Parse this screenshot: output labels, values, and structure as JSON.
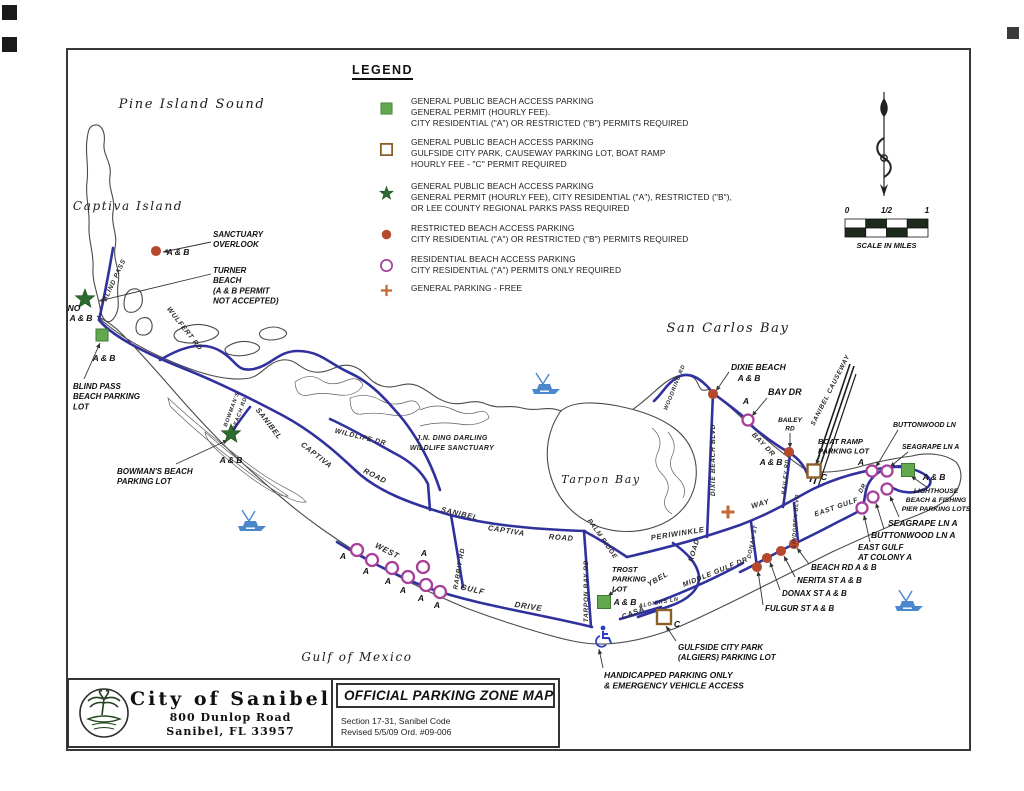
{
  "title_block": {
    "city_name": "City of Sanibel",
    "address_line1": "800 Dunlop Road",
    "address_line2": "Sanibel, FL  33957",
    "map_title": "OFFICIAL PARKING ZONE MAP",
    "section_line1": "Section 17-31, Sanibel Code",
    "section_line2": "Revised 5/5/09 Ord. #09-006"
  },
  "legend": {
    "title": "LEGEND",
    "items": [
      {
        "marker": "green-square",
        "top": 96,
        "lines": [
          "GENERAL PUBLIC BEACH ACCESS PARKING",
          "GENERAL PERMIT (HOURLY FEE).",
          "CITY RESIDENTIAL (\"A\") OR RESTRICTED (\"B\") PERMITS REQUIRED"
        ]
      },
      {
        "marker": "open-square",
        "top": 137,
        "lines": [
          "GENERAL PUBLIC BEACH ACCESS PARKING",
          "GULFSIDE CITY PARK, CAUSEWAY PARKING LOT, BOAT RAMP",
          "HOURLY FEE - \"C\" PERMIT REQUIRED"
        ]
      },
      {
        "marker": "green-star",
        "top": 181,
        "lines": [
          "GENERAL PUBLIC BEACH ACCESS PARKING",
          "GENERAL PERMIT (HOURLY FEE), CITY RESIDENTIAL (\"A\"), RESTRICTED (\"B\"),",
          "OR LEE COUNTY REGIONAL PARKS PASS REQUIRED"
        ]
      },
      {
        "marker": "red-dot",
        "top": 223,
        "lines": [
          "RESTRICTED BEACH ACCESS PARKING",
          "CITY RESIDENTIAL (\"A\") OR RESTRICTED (\"B\") PERMITS REQUIRED"
        ]
      },
      {
        "marker": "open-circle",
        "top": 254,
        "lines": [
          "RESIDENTIAL BEACH ACCESS PARKING",
          "CITY RESIDENTIAL (\"A\") PERMITS ONLY REQUIRED"
        ]
      },
      {
        "marker": "plus",
        "top": 283,
        "lines": [
          "GENERAL PARKING - FREE"
        ]
      }
    ]
  },
  "scale_bar": {
    "ticks": [
      "0",
      "1/2",
      "1"
    ],
    "caption": "SCALE IN MILES"
  },
  "water_labels": [
    {
      "text": "Pine Island Sound",
      "x": 192,
      "y": 108,
      "size": 13
    },
    {
      "text": "Captiva Island",
      "x": 128,
      "y": 210,
      "size": 12
    },
    {
      "text": "San Carlos Bay",
      "x": 728,
      "y": 332,
      "size": 13
    },
    {
      "text": "Tarpon Bay",
      "x": 601,
      "y": 483,
      "size": 11
    },
    {
      "text": "Gulf of Mexico",
      "x": 357,
      "y": 661,
      "size": 12
    }
  ],
  "area_labels": [
    {
      "text": "J.N. DING DARLING",
      "x": 452,
      "y": 440
    },
    {
      "text": "WILDLIFE SANCTUARY",
      "x": 452,
      "y": 450
    }
  ],
  "road_labels": [
    {
      "text": "BLIND PASS",
      "x": 116,
      "y": 281,
      "rot": -65,
      "size": 6.5
    },
    {
      "text": "WULFERT RD",
      "x": 183,
      "y": 330,
      "rot": 52,
      "size": 7
    },
    {
      "text": "SANIBEL",
      "x": 267,
      "y": 425,
      "rot": 52,
      "size": 7.5
    },
    {
      "text": "CAPTIVA",
      "x": 315,
      "y": 457,
      "rot": 38,
      "size": 7.5
    },
    {
      "text": "ROAD",
      "x": 374,
      "y": 478,
      "rot": 27,
      "size": 7.5
    },
    {
      "text": "BOWMAN'S",
      "x": 233,
      "y": 410,
      "rot": -70,
      "size": 5.5
    },
    {
      "text": "BEACH RD",
      "x": 241,
      "y": 414,
      "rot": -70,
      "size": 5.5
    },
    {
      "text": "WILDLIFE DR",
      "x": 360,
      "y": 439,
      "rot": 14,
      "size": 7
    },
    {
      "text": "SANIBEL",
      "x": 459,
      "y": 516,
      "rot": 13,
      "size": 7.5
    },
    {
      "text": "CAPTIVA",
      "x": 506,
      "y": 533,
      "rot": 9,
      "size": 7.5
    },
    {
      "text": "ROAD",
      "x": 561,
      "y": 540,
      "rot": 4,
      "size": 7.5
    },
    {
      "text": "RABBIT RD",
      "x": 461,
      "y": 569,
      "rot": -80,
      "size": 6.5
    },
    {
      "text": "WEST",
      "x": 386,
      "y": 553,
      "rot": 27,
      "size": 8
    },
    {
      "text": "GULF",
      "x": 472,
      "y": 592,
      "rot": 13,
      "size": 8
    },
    {
      "text": "DRIVE",
      "x": 528,
      "y": 609,
      "rot": 9,
      "size": 8
    },
    {
      "text": "TARPON BAY RD",
      "x": 588,
      "y": 591,
      "rot": -90,
      "size": 6.5
    },
    {
      "text": "PALM RIDGE",
      "x": 601,
      "y": 540,
      "rot": 55,
      "size": 6.5
    },
    {
      "text": "PERIWINKLE",
      "x": 678,
      "y": 536,
      "rot": -9,
      "size": 7.5
    },
    {
      "text": "WAY",
      "x": 761,
      "y": 506,
      "rot": -16,
      "size": 7.5
    },
    {
      "text": "DIXIE BEACH BLVD",
      "x": 715,
      "y": 460,
      "rot": -90,
      "size": 6.5
    },
    {
      "text": "WOODRING RD",
      "x": 676,
      "y": 388,
      "rot": -68,
      "size": 5.5
    },
    {
      "text": "BAY DR",
      "x": 762,
      "y": 446,
      "rot": 46,
      "size": 7
    },
    {
      "text": "BAILEY RD",
      "x": 787,
      "y": 477,
      "rot": -84,
      "size": 5.5
    },
    {
      "text": "SANIBEL CAUSEWAY",
      "x": 832,
      "y": 391,
      "rot": -63,
      "size": 6.5
    },
    {
      "text": "LINDGREN BLVD",
      "x": 797,
      "y": 521,
      "rot": -86,
      "size": 5.5
    },
    {
      "text": "EAST GULF",
      "x": 837,
      "y": 509,
      "rot": -19,
      "size": 7
    },
    {
      "text": "DR",
      "x": 864,
      "y": 489,
      "rot": -60,
      "size": 6
    },
    {
      "text": "MIDDLE GULF DR",
      "x": 716,
      "y": 574,
      "rot": -22,
      "size": 7
    },
    {
      "text": "CASA",
      "x": 634,
      "y": 615,
      "rot": -22,
      "size": 7.5
    },
    {
      "text": "YBEL",
      "x": 659,
      "y": 581,
      "rot": -30,
      "size": 7.5
    },
    {
      "text": "ROAD",
      "x": 696,
      "y": 551,
      "rot": -73,
      "size": 7
    },
    {
      "text": "ALGIERS LN",
      "x": 659,
      "y": 604,
      "rot": -10,
      "size": 5.5
    },
    {
      "text": "DONAX ST",
      "x": 754,
      "y": 542,
      "rot": -78,
      "size": 5.5
    }
  ],
  "callouts": [
    {
      "lines": [
        "SANCTUARY",
        "OVERLOOK"
      ],
      "x": 213,
      "y": 237,
      "size": 8,
      "leader": [
        211,
        242,
        163,
        252
      ]
    },
    {
      "lines": [
        "TURNER",
        "BEACH",
        "(A & B PERMIT",
        "NOT ACCEPTED)"
      ],
      "x": 213,
      "y": 273,
      "size": 8,
      "leader": [
        211,
        274,
        99,
        301
      ]
    },
    {
      "lines": [
        "BLIND PASS",
        "BEACH PARKING",
        "LOT"
      ],
      "x": 73,
      "y": 389,
      "size": 8,
      "leader": [
        84,
        379,
        100,
        343
      ]
    },
    {
      "lines": [
        "BOWMAN'S BEACH",
        "PARKING LOT"
      ],
      "x": 117,
      "y": 474,
      "size": 8,
      "leader": [
        176,
        464,
        228,
        440
      ]
    },
    {
      "lines": [
        "TROST",
        "PARKING",
        "LOT"
      ],
      "x": 612,
      "y": 572,
      "size": 7.5,
      "leader": [
        617,
        589,
        608,
        596
      ]
    },
    {
      "lines": [
        "GULFSIDE CITY PARK",
        "(ALGIERS) PARKING LOT"
      ],
      "x": 678,
      "y": 650,
      "size": 8,
      "leader": [
        676,
        641,
        666,
        626
      ]
    },
    {
      "lines": [
        "HANDICAPPED PARKING ONLY",
        "& EMERGENCY VEHICLE ACCESS"
      ],
      "x": 604,
      "y": 678,
      "size": 8.5,
      "leader": [
        603,
        668,
        599,
        649
      ]
    },
    {
      "lines": [
        "DIXIE BEACH"
      ],
      "x": 731,
      "y": 370,
      "size": 8.5,
      "leader": [
        729,
        372,
        716,
        391
      ]
    },
    {
      "lines": [
        "BAY DR"
      ],
      "x": 768,
      "y": 395,
      "size": 9,
      "leader": [
        767,
        398,
        752,
        416
      ]
    },
    {
      "lines": [
        "BAILEY",
        "RD"
      ],
      "x": 790,
      "y": 422,
      "size": 6.5,
      "align": "center",
      "leader": [
        790,
        433,
        790,
        448
      ]
    },
    {
      "lines": [
        "BOAT RAMP",
        "PARKING LOT"
      ],
      "x": 818,
      "y": 444,
      "size": 7.5,
      "leader": [
        820,
        455,
        816,
        465
      ]
    },
    {
      "lines": [
        "BUTTONWOOD LN"
      ],
      "x": 893,
      "y": 427,
      "size": 7,
      "leader": [
        898,
        430,
        876,
        467
      ]
    },
    {
      "lines": [
        "SEAGRAPE LN  A"
      ],
      "x": 902,
      "y": 449,
      "size": 7,
      "leader": [
        908,
        452,
        890,
        467
      ]
    },
    {
      "lines": [
        "LIGHTHOUSE",
        "BEACH & FISHING",
        "PIER PARKING LOTS"
      ],
      "x": 936,
      "y": 493,
      "size": 6.8,
      "align": "center",
      "leader": [
        928,
        488,
        911,
        476
      ]
    },
    {
      "lines": [
        "SEAGRAPE LN A"
      ],
      "x": 888,
      "y": 526,
      "size": 8.5,
      "leader": [
        899,
        517,
        890,
        496
      ]
    },
    {
      "lines": [
        "BUTTONWOOD LN A"
      ],
      "x": 871,
      "y": 538,
      "size": 8.5,
      "leader": [
        884,
        529,
        876,
        503
      ]
    },
    {
      "lines": [
        "EAST GULF",
        "AT COLONY  A"
      ],
      "x": 858,
      "y": 550,
      "size": 8,
      "leader": [
        870,
        542,
        864,
        515
      ]
    },
    {
      "lines": [
        "BEACH RD  A & B"
      ],
      "x": 811,
      "y": 570,
      "size": 8,
      "leader": [
        809,
        564,
        797,
        548
      ]
    },
    {
      "lines": [
        "NERITA ST  A & B"
      ],
      "x": 797,
      "y": 583,
      "size": 8,
      "leader": [
        795,
        577,
        784,
        556
      ]
    },
    {
      "lines": [
        "DONAX ST   A & B"
      ],
      "x": 782,
      "y": 596,
      "size": 8,
      "leader": [
        780,
        590,
        770,
        562
      ]
    },
    {
      "lines": [
        "FULGUR ST   A & B"
      ],
      "x": 765,
      "y": 611,
      "size": 8,
      "leader": [
        763,
        605,
        758,
        571
      ]
    }
  ],
  "point_labels": [
    {
      "text": "A & B",
      "x": 178,
      "y": 255
    },
    {
      "text": "NO",
      "x": 74,
      "y": 311
    },
    {
      "text": "A & B",
      "x": 81,
      "y": 321
    },
    {
      "text": "A & B",
      "x": 104,
      "y": 361
    },
    {
      "text": "A & B",
      "x": 231,
      "y": 463
    },
    {
      "text": "A & B",
      "x": 625,
      "y": 605
    },
    {
      "text": "A & B",
      "x": 749,
      "y": 381
    },
    {
      "text": "A & B",
      "x": 771,
      "y": 465
    },
    {
      "text": "C",
      "x": 824,
      "y": 480
    },
    {
      "text": "C",
      "x": 677,
      "y": 627
    },
    {
      "text": "A & B",
      "x": 934,
      "y": 480
    },
    {
      "text": "A",
      "x": 861,
      "y": 465
    },
    {
      "text": "A",
      "x": 746,
      "y": 404
    },
    {
      "text": "A",
      "x": 343,
      "y": 559
    },
    {
      "text": "A",
      "x": 366,
      "y": 574
    },
    {
      "text": "A",
      "x": 388,
      "y": 584
    },
    {
      "text": "A",
      "x": 403,
      "y": 593
    },
    {
      "text": "A",
      "x": 421,
      "y": 601
    },
    {
      "text": "A",
      "x": 437,
      "y": 608
    },
    {
      "text": "A",
      "x": 424,
      "y": 556
    }
  ],
  "markers": {
    "green_squares": [
      [
        102,
        335,
        12
      ],
      [
        604,
        602,
        13
      ],
      [
        908,
        470,
        13
      ]
    ],
    "green_stars": [
      [
        85,
        299
      ],
      [
        231,
        434
      ]
    ],
    "red_dots": [
      [
        156,
        251
      ],
      [
        713,
        394
      ],
      [
        789,
        452
      ],
      [
        757,
        567
      ],
      [
        767,
        558
      ],
      [
        781,
        551
      ],
      [
        794,
        544
      ]
    ],
    "open_circles": [
      [
        357,
        550
      ],
      [
        372,
        560
      ],
      [
        392,
        568
      ],
      [
        408,
        577
      ],
      [
        426,
        585
      ],
      [
        440,
        592
      ],
      [
        423,
        567
      ],
      [
        748,
        420,
        5.5
      ],
      [
        872,
        471,
        5.5
      ],
      [
        887,
        471,
        5.5
      ],
      [
        887,
        489,
        5.5
      ],
      [
        873,
        497,
        5.5
      ],
      [
        862,
        508,
        5.5
      ]
    ],
    "open_squares": [
      [
        814,
        471,
        13
      ],
      [
        664,
        617,
        14
      ]
    ],
    "plus_signs": [
      [
        728,
        512
      ]
    ]
  },
  "boats": [
    [
      252,
      522
    ],
    [
      546,
      385
    ],
    [
      909,
      602
    ]
  ],
  "handicap_icon": {
    "x": 602,
    "y": 636
  },
  "colors": {
    "road_blue": "#31319e",
    "outline_gray": "#4a4a4a",
    "green": "#63a84f",
    "green_dark": "#2e6b2e",
    "red": "#b5492f",
    "magenta": "#a8409a",
    "brown": "#8a5f28",
    "orange": "#c06a32",
    "boat_blue": "#4b87cc",
    "handicap_blue": "#2a3fbf",
    "scale_dark": "#1c2b1c"
  }
}
